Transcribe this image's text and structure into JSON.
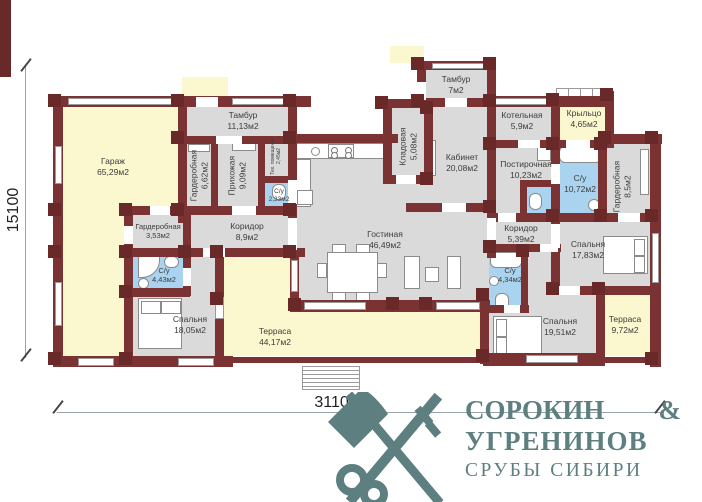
{
  "plan": {
    "rooms": {
      "garage": {
        "name": "Гараж",
        "area": "65,29м2"
      },
      "tambour1": {
        "name": "Тамбур",
        "area": "11,13м2"
      },
      "wardrobe1": {
        "name": "Гардеробная",
        "area": "6,62м2"
      },
      "hallway": {
        "name": "Прихожая",
        "area": "9,09м2"
      },
      "tech": {
        "name": "Тех. помещение",
        "area": "2,45м2"
      },
      "wc_small": {
        "name": "С/у",
        "area": "2,33м2"
      },
      "pantry": {
        "name": "Кладовая",
        "area": "5,08м2"
      },
      "tambour2": {
        "name": "Тамбур",
        "area": "7м2"
      },
      "study": {
        "name": "Кабинет",
        "area": "20,08м2"
      },
      "boiler": {
        "name": "Котельная",
        "area": "5,9м2"
      },
      "porch": {
        "name": "Крыльцо",
        "area": "4,65м2"
      },
      "laundry": {
        "name": "Постирочная",
        "area": "10,23м2"
      },
      "bath_big": {
        "name": "С/у",
        "area": "10,72м2"
      },
      "wardrobe2": {
        "name": "Гардеробная",
        "area": "8,5м2"
      },
      "corridor1": {
        "name": "Коридор",
        "area": "8,9м2"
      },
      "wardrobe3": {
        "name": "Гардеробная",
        "area": "3,53м2"
      },
      "bath2": {
        "name": "С/у",
        "area": "4,43м2"
      },
      "bedroom1": {
        "name": "Спальня",
        "area": "18,05м2"
      },
      "living": {
        "name": "Гостиная",
        "area": "46,49м2"
      },
      "terrace1": {
        "name": "Терраса",
        "area": "44,17м2"
      },
      "corridor2": {
        "name": "Коридор",
        "area": "5,39м2"
      },
      "bedroom2": {
        "name": "Спальня",
        "area": "17,83м2"
      },
      "bath3": {
        "name": "С/у",
        "area": "4,34м2"
      },
      "bedroom3": {
        "name": "Спальня",
        "area": "19,51м2"
      },
      "terrace2": {
        "name": "Терраса",
        "area": "9,72м2"
      }
    },
    "dimensions": {
      "height_mm": "15100",
      "width_mm": "31100"
    },
    "colors": {
      "wall": "#7a3232",
      "room": "#dadada",
      "wet": "#a9d3ee",
      "outdoor": "#fbf7cf",
      "logo": "#5e7f80"
    }
  },
  "logo": {
    "name1": "СОРОКИН",
    "amp": "&",
    "name2": "УГРЕНИНОВ",
    "tagline": "СРУБЫ СИБИРИ"
  }
}
